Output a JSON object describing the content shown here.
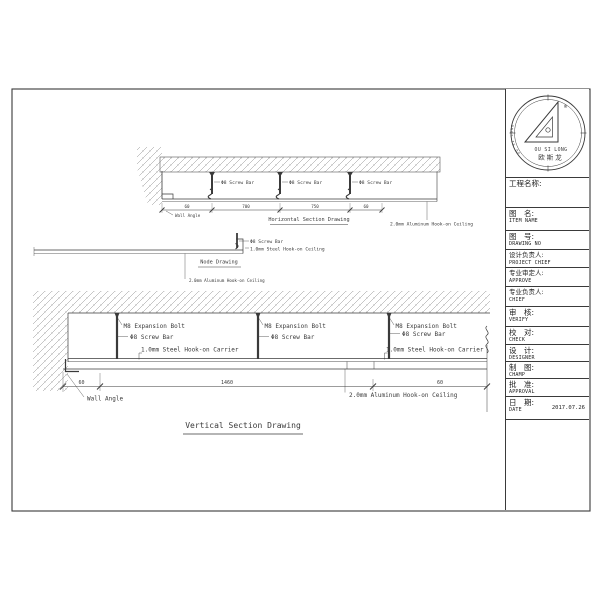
{
  "sheet": {
    "top_drawing": {
      "title": "Horizontal Section Drawing",
      "labels": {
        "screw_bar": "Φ8 Screw Bar",
        "wall_angle": "Wall Angle",
        "aluminum_ceiling": "2.0mm Aluminum Hook-on Ceiling"
      },
      "dims": [
        "60",
        "700",
        "750",
        "60"
      ]
    },
    "node_drawing": {
      "title": "Node Drawing",
      "labels": {
        "screw_bar": "Φ8 Screw Bar",
        "steel_ceiling": "1.0mm Steel Hook-on Ceiling",
        "aluminum_ceiling": "2.0mm Aluminum Hook-on Ceiling"
      }
    },
    "vertical_drawing": {
      "title": "Vertical Section Drawing",
      "labels": {
        "expansion_bolt": "M8 Expansion Bolt",
        "screw_bar": "Φ8 Screw Bar",
        "steel_carrier": "1.0mm Steel Hook-on Carrier",
        "wall_angle": "Wall Angle",
        "aluminum_ceiling": "2.0mm Aluminum Hook-on Ceiling"
      },
      "dims": [
        "60",
        "1460",
        "60"
      ]
    },
    "title_block": {
      "stamp": {
        "arc_text": "OU SI LONG",
        "name_en": "OU SI LONG",
        "name_cn": "欧斯龙",
        "registered": "®"
      },
      "project_name_label": "工程名称:",
      "rows": [
        {
          "cn": "图　名:",
          "en": "ITEM NAME"
        },
        {
          "cn": "图　号:",
          "en": "DRAWING NO"
        },
        {
          "cn": "设计负责人:",
          "en": "PROJECT CHIEF"
        },
        {
          "cn": "专业审定人:",
          "en": "APPROVE"
        },
        {
          "cn": "专业负责人:",
          "en": "CHIEF"
        },
        {
          "cn": "审　核:",
          "en": "VERIFY"
        },
        {
          "cn": "校　对:",
          "en": "CHECK"
        },
        {
          "cn": "设　计:",
          "en": "DESIGNER"
        },
        {
          "cn": "制　图:",
          "en": "CHAMP"
        },
        {
          "cn": "批　准:",
          "en": "APPROVAL"
        },
        {
          "cn": "日　期:",
          "en": "DATE",
          "value": "2017.07.26"
        }
      ]
    },
    "colors": {
      "line": "#3a3a3a",
      "background": "#ffffff",
      "hatch": "#8f8f8f"
    }
  }
}
